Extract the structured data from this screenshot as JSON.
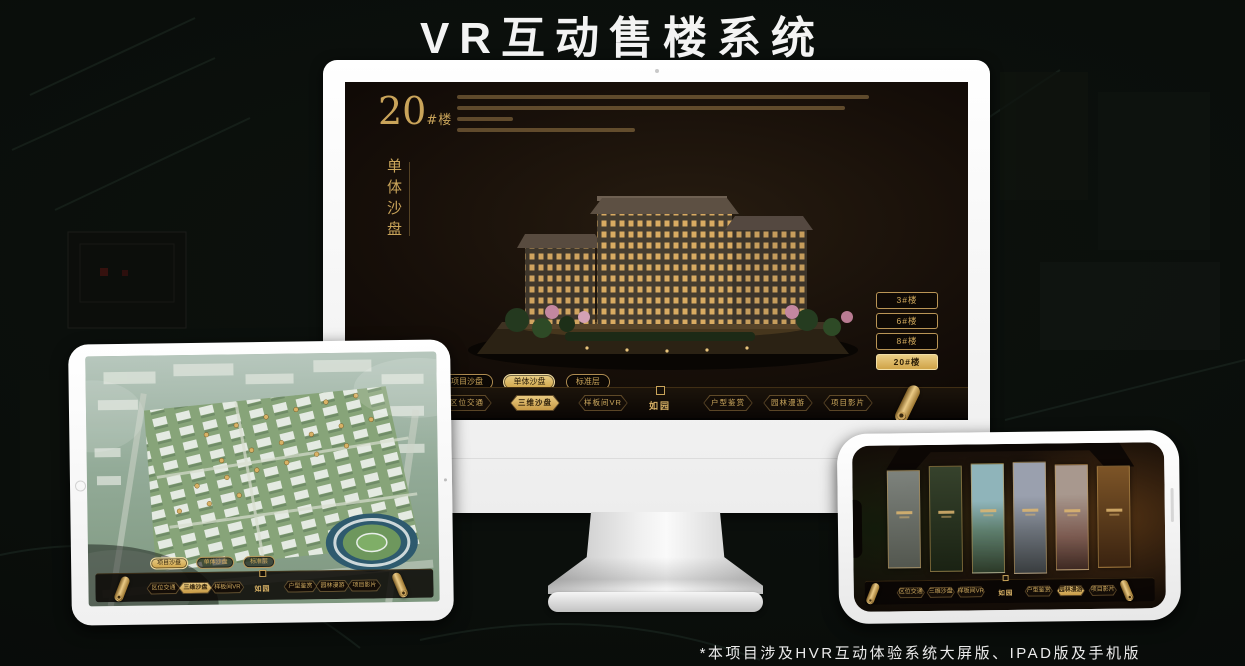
{
  "page": {
    "title": "VR互动售楼系统",
    "footnote": "*本项目涉及HVR互动体验系统大屏版、IPAD版及手机版"
  },
  "shared": {
    "logo": "如园",
    "nav_items": [
      "区位交通",
      "三维沙盘",
      "样板间VR",
      "户型鉴赏",
      "园林漫游",
      "项目影片"
    ],
    "sub_tabs": [
      "项目沙盘",
      "单体沙盘",
      "标准层"
    ]
  },
  "monitor_app": {
    "headline_number": "20",
    "headline_unit": "#楼",
    "headline_subtitle": "单体沙盘",
    "floor_buttons": [
      "3#楼",
      "6#楼",
      "8#楼",
      "20#楼"
    ],
    "active_floor": "20#楼",
    "active_sub_tab": "单体沙盘",
    "active_nav": "三维沙盘"
  },
  "tablet_app": {
    "active_sub_tab": "项目沙盘",
    "active_nav": "三维沙盘"
  },
  "phone_app": {
    "active_nav": "园林漫游"
  },
  "colors": {
    "gold": "#C9A45A",
    "gold_active": "#D9B266",
    "screen_bg": "#17110B",
    "title_text": "#F3F3F3"
  }
}
